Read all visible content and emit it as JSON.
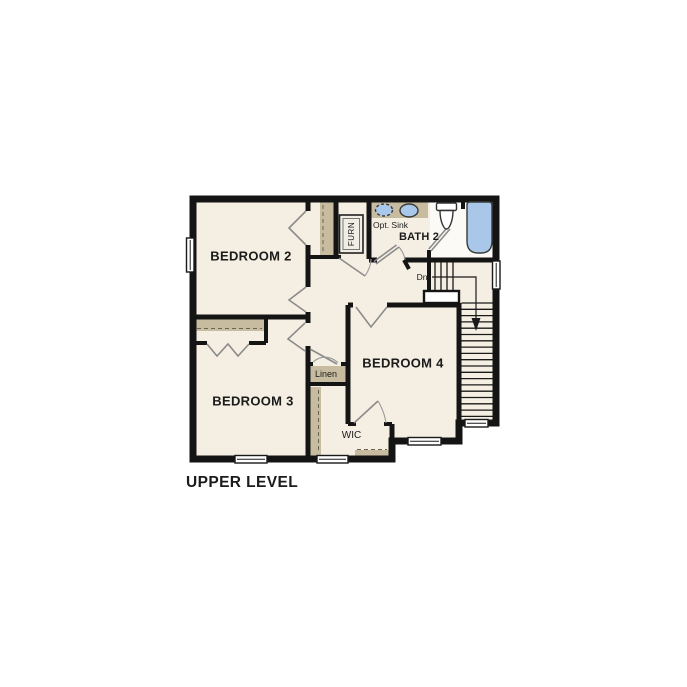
{
  "title": "UPPER LEVEL",
  "rooms": {
    "bedroom2": "BEDROOM 2",
    "bedroom3": "BEDROOM 3",
    "bedroom4": "BEDROOM 4",
    "bath2": "BATH 2"
  },
  "labels": {
    "opt_sink": "Opt. Sink",
    "furnace": "FURN",
    "linen": "Linen",
    "wic": "WIC",
    "stairs_down": "Dn"
  },
  "colors": {
    "wall": "#141414",
    "floor": "#f4efe2",
    "tan": "#c8bca0",
    "fixture_blue": "#a9c8e9",
    "white_zone": "#fbfaf6"
  }
}
